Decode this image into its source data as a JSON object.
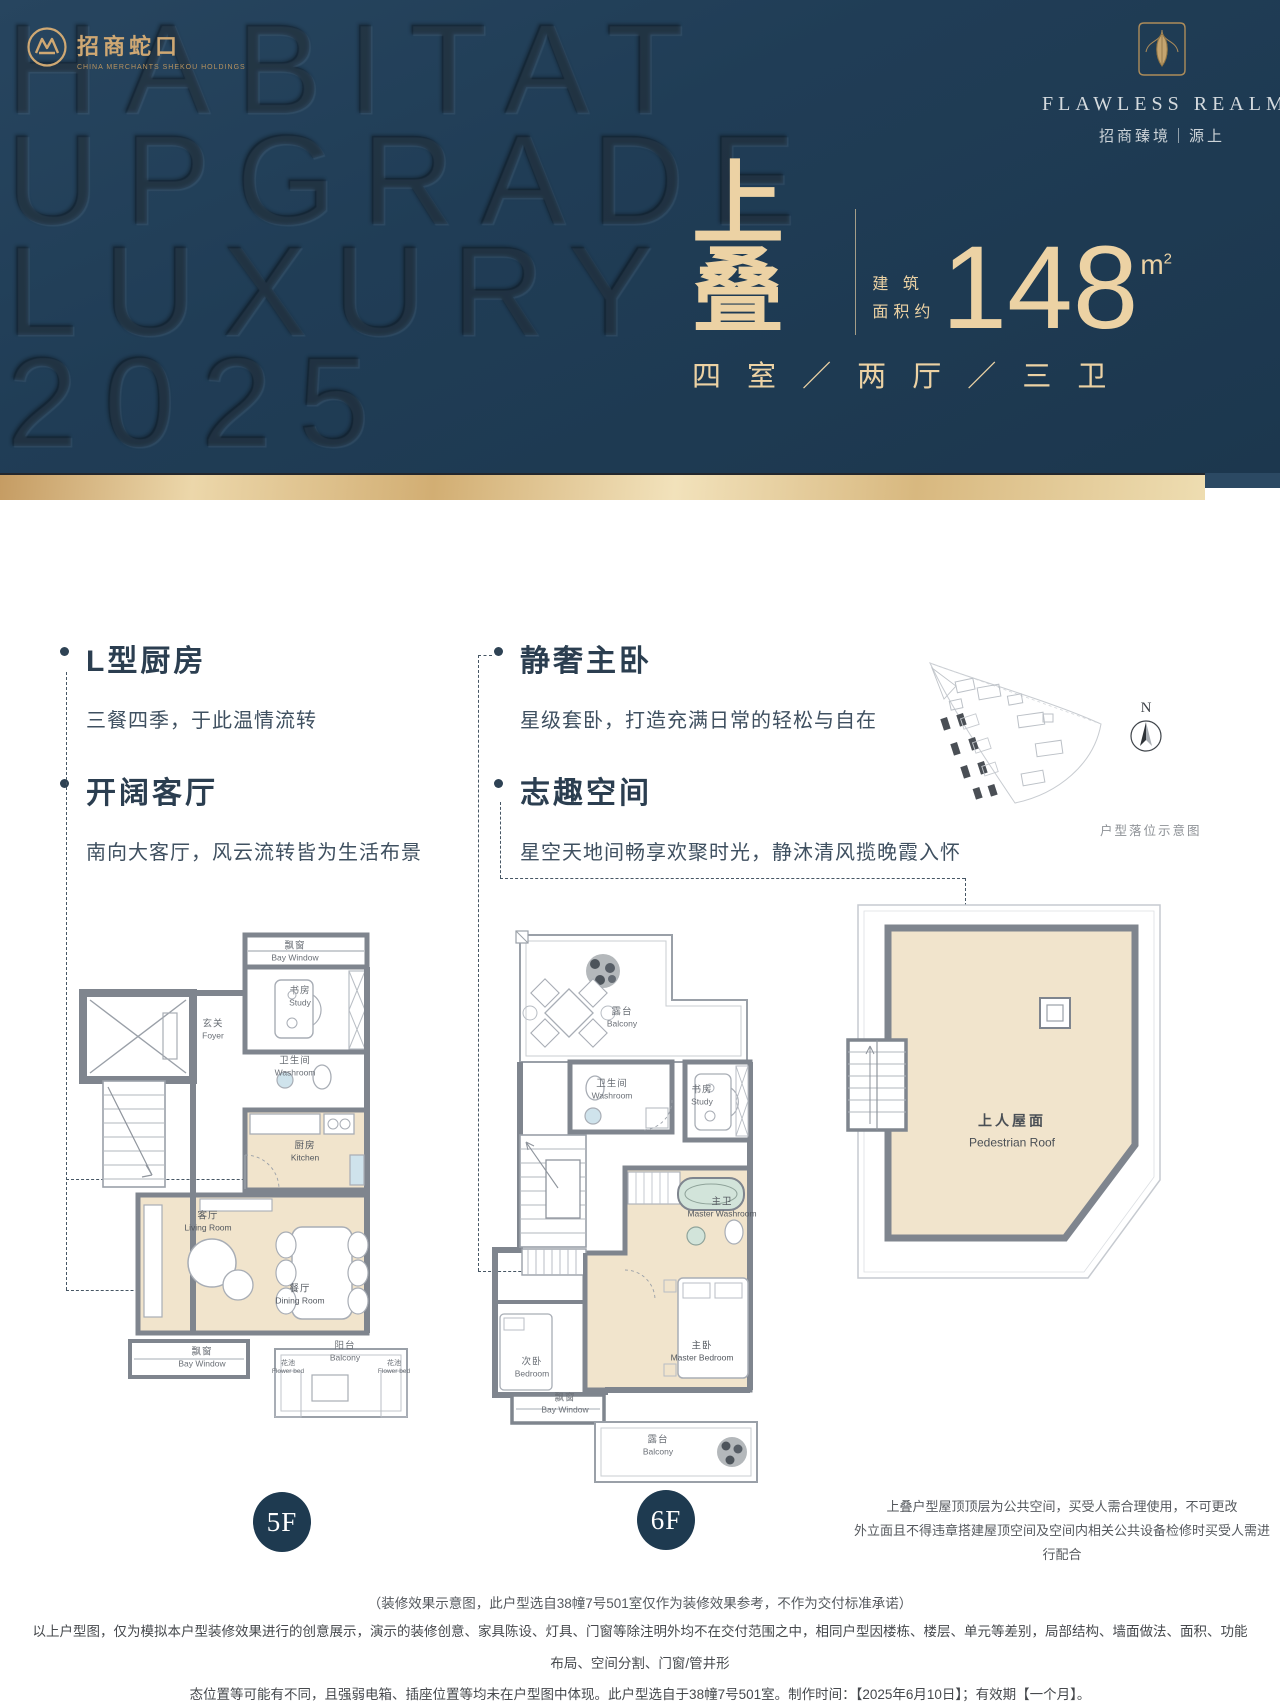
{
  "hero": {
    "watermark": [
      "HABITAT",
      "UPGRADE",
      "LUXURY",
      "2025"
    ],
    "brand_left": {
      "name": "招商蛇口",
      "sub": "CHINA MERCHANTS SHEKOU HOLDINGS"
    },
    "brand_right": {
      "en": "FLAWLESS REALM",
      "zh": "招商臻境｜源上"
    },
    "unit": {
      "type": "上叠",
      "area_l1": "建 筑",
      "area_l2": "面积约",
      "area_value": "148",
      "area_unit": "m",
      "area_sup": "2",
      "layout": "四 室 ／ 两 厅 ／ 三 卫"
    }
  },
  "features": {
    "items": [
      {
        "title": "L型厨房",
        "desc": "三餐四季，于此温情流转"
      },
      {
        "title": "开阔客厅",
        "desc": "南向大客厅，风云流转皆为生活布景"
      },
      {
        "title": "静奢主卧",
        "desc": "星级套卧，打造充满日常的轻松与自在"
      },
      {
        "title": "志趣空间",
        "desc": "星空天地间畅享欢聚时光，静沐清风揽晚霞入怀"
      }
    ]
  },
  "siteplan": {
    "caption": "户型落位示意图",
    "compass": "N"
  },
  "plans": {
    "f5": {
      "badge": "5F",
      "rooms": [
        {
          "zh": "飘窗",
          "en": "Bay Window"
        },
        {
          "zh": "书房",
          "en": "Study"
        },
        {
          "zh": "玄关",
          "en": "Foyer"
        },
        {
          "zh": "卫生间",
          "en": "Washroom"
        },
        {
          "zh": "厨房",
          "en": "Kitchen"
        },
        {
          "zh": "客厅",
          "en": "Living Room"
        },
        {
          "zh": "餐厅",
          "en": "Dining Room"
        },
        {
          "zh": "飘窗",
          "en": "Bay Window"
        },
        {
          "zh": "阳台",
          "en": "Balcony"
        },
        {
          "zh": "花池",
          "en": "Flower bed"
        },
        {
          "zh": "花池",
          "en": "Flower bed"
        }
      ]
    },
    "f6": {
      "badge": "6F",
      "rooms": [
        {
          "zh": "露台",
          "en": "Balcony"
        },
        {
          "zh": "卫生间",
          "en": "Washroom"
        },
        {
          "zh": "书房",
          "en": "Study"
        },
        {
          "zh": "主卫",
          "en": "Master Washroom"
        },
        {
          "zh": "主卧",
          "en": "Master Bedroom"
        },
        {
          "zh": "次卧",
          "en": "Bedroom"
        },
        {
          "zh": "飘窗",
          "en": "Bay Window"
        },
        {
          "zh": "露台",
          "en": "Balcony"
        }
      ]
    },
    "roof": {
      "zh": "上人屋面",
      "en": "Pedestrian Roof"
    }
  },
  "notes": {
    "roof_1": "上叠户型屋顶顶层为公共空间，买受人需合理使用，不可更改",
    "roof_2": "外立面且不得违章搭建屋顶空间及空间内相关公共设备检修时买受人需进行配合",
    "center": "（装修效果示意图，此户型选自38幢7号501室仅作为装修效果参考，不作为交付标准承诺）",
    "disc_1": "以上户型图，仅为模拟本户型装修效果进行的创意展示，演示的装修创意、家具陈设、灯具、门窗等除注明外均不在交付范围之中，相同户型因楼栋、楼层、单元等差别，局部结构、墙面做法、面积、功能布局、空间分割、门窗/管井形",
    "disc_2": "态位置等可能有不同，且强弱电箱、插座位置等均未在户型图中体现。此户型选自于38幢7号501室。制作时间：【2025年6月10日】；有效期【一个月】。"
  },
  "colors": {
    "navy": "#1f3b53",
    "gold_text": "#ecd2a4",
    "gold_bar": "#d9b87f",
    "beige_room": "#f1e4cc",
    "wall_gray": "#7f858e",
    "badge_navy": "#1e3a50"
  }
}
